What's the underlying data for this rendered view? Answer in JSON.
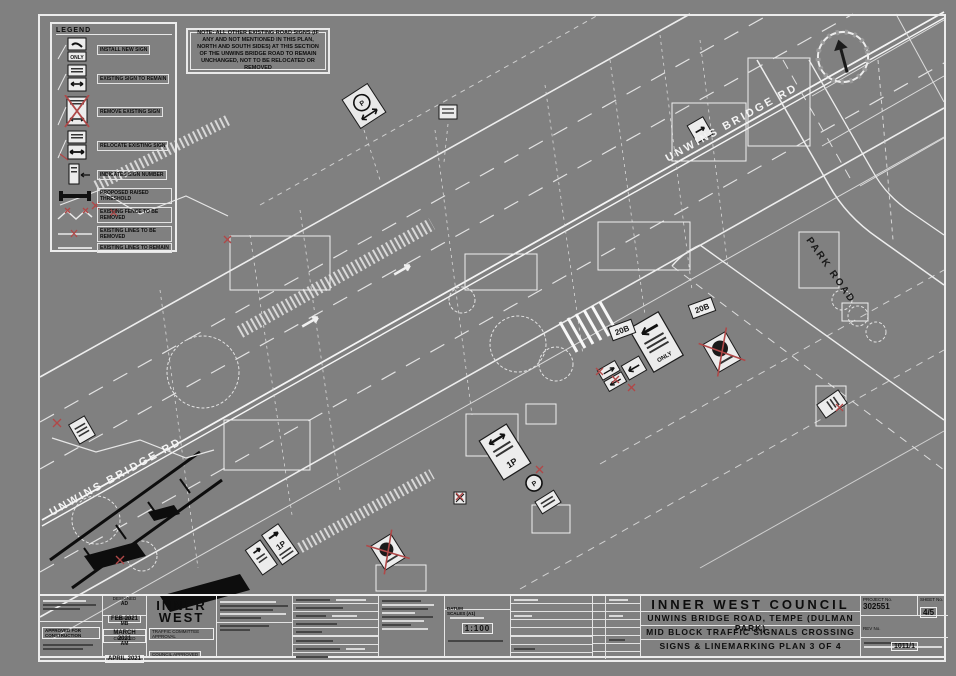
{
  "legend": {
    "title": "LEGEND",
    "only_text": "ONLY",
    "items": [
      {
        "label": "INSTALL NEW SIGN"
      },
      {
        "label": "EXISTING SIGN TO REMAIN"
      },
      {
        "label": "REMOVE EXISTING SIGN"
      },
      {
        "label": "RELOCATE EXISTING SIGN"
      },
      {
        "label": "INDICATES SIGN NUMBER"
      },
      {
        "label": "PROPOSED RAISED THRESHOLD"
      },
      {
        "label": "EXISTING FENCE TO BE REMOVED"
      },
      {
        "label": "EXISTING LINES TO BE REMOVED"
      },
      {
        "label": "EXISTING LINES TO REMAIN"
      }
    ]
  },
  "note": "NOTE: ALL OTHER EXISTING ROAD SIGNS (IF ANY AND NOT MENTIONED IN THIS PLAN, NORTH AND SOUTH SIDES) AT THIS SECTION OF THE UNWINS BRIDGE ROAD TO REMAIN UNCHANGED, NOT TO BE RELOCATED OR REMOVED",
  "plan": {
    "road_label_1": "UNWINS BRIDGE RD",
    "road_label_2": "UNWINS BRIDGE RD",
    "road_label_3": "PARK ROAD",
    "tag_20b_a": "20B",
    "tag_20b_b": "20B",
    "sign_texts": {
      "only": "ONLY",
      "p1": "1P",
      "p2": "1P",
      "p_circle": "P"
    }
  },
  "title_block": {
    "council": "INNER WEST COUNCIL",
    "project_line1": "UNWINS BRIDGE ROAD, TEMPE (DULMAN PARK)",
    "project_line2": "MID BLOCK TRAFFIC SIGNALS CROSSING",
    "project_line3": "SIGNS & LINEMARKING PLAN 3 OF 4",
    "project_no_label": "PROJECT No.",
    "project_no": "302551",
    "sheet_no_label": "SHEET No.",
    "sheet_no": "4/5",
    "rev_label": "REV No.",
    "rev_no": "1011/1",
    "logo_line1": "INNER",
    "logo_line2": "WEST",
    "approval1": "TRAFFIC COMMITTEE APPROVAL",
    "approval2": "COUNCIL APPROVED",
    "stamp": "APPROVED FOR CONSTRUCTION",
    "datum_label": "DATUM",
    "scale_label": "SCALES (A1)",
    "scale_value": "1:100",
    "dates": [
      {
        "role": "DESIGNED",
        "initials": "AD",
        "date": "FEB 2021"
      },
      {
        "role": "DRAWN",
        "initials": "MB",
        "date": "MARCH 2021"
      },
      {
        "role": "CHECKED",
        "initials": "AM",
        "date": "APRIL 2021"
      }
    ]
  }
}
